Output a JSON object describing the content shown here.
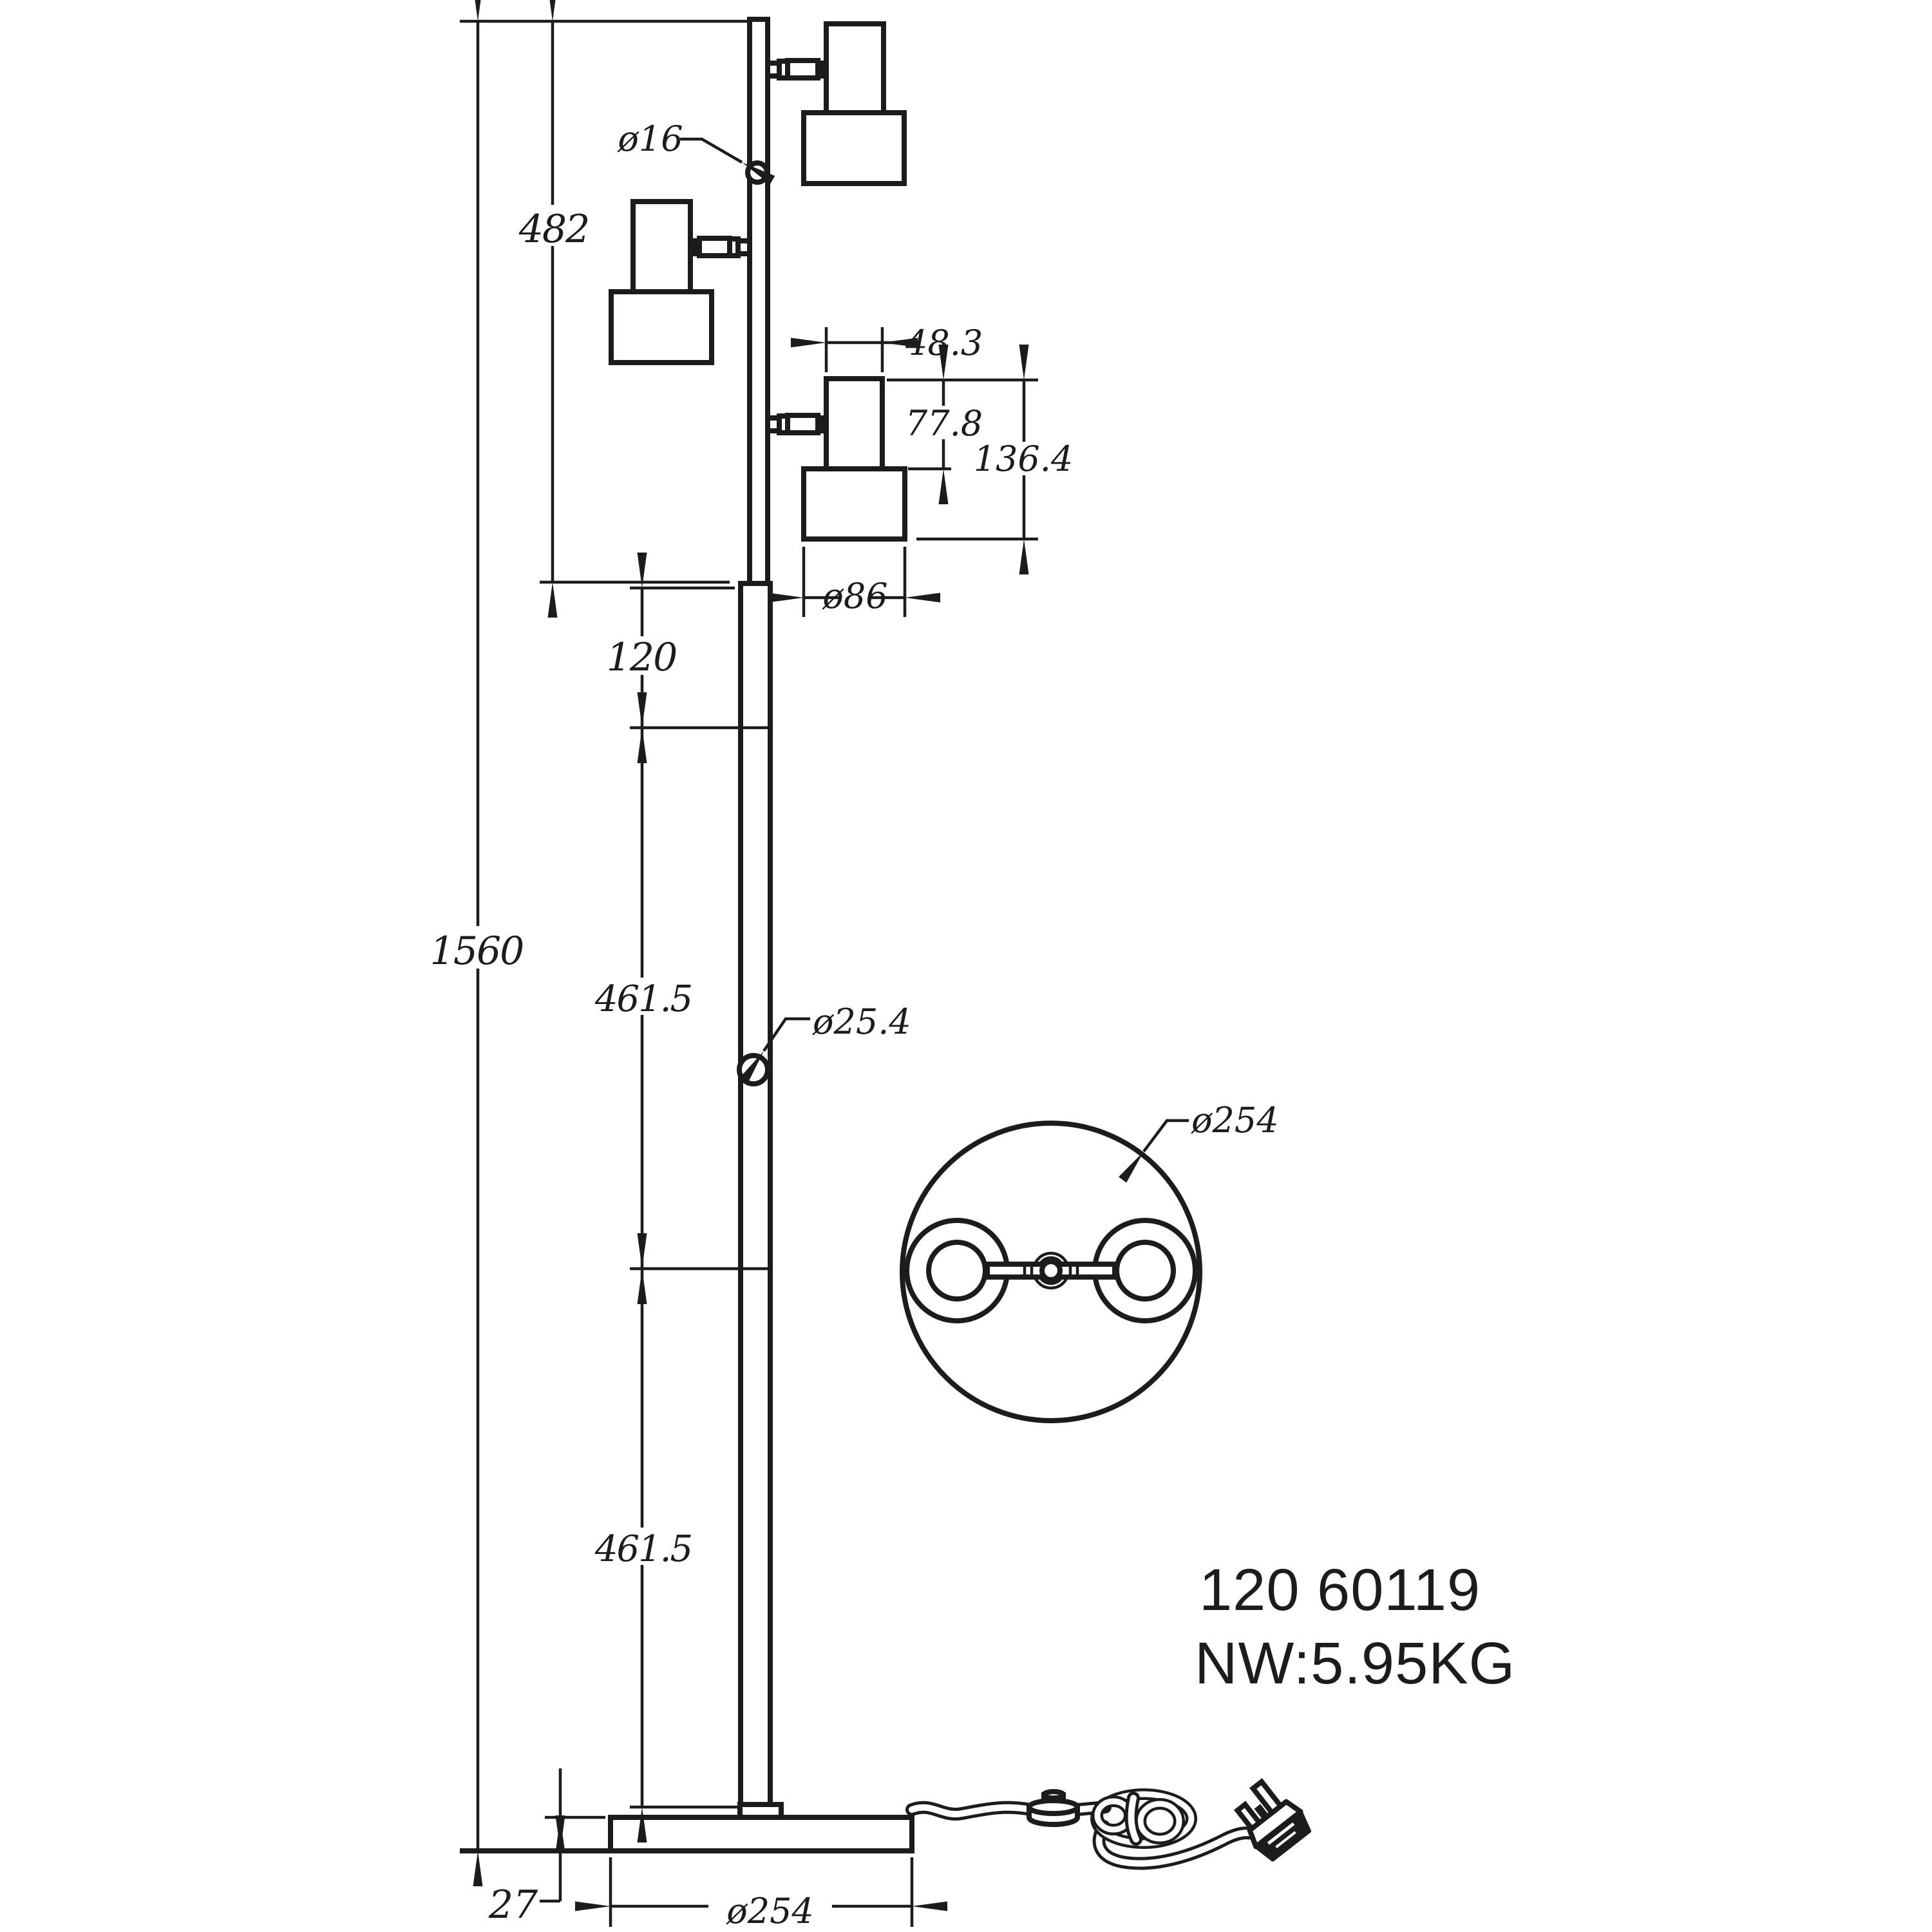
{
  "front_view": {
    "overall_height": "1560",
    "upper_section_height": "482",
    "upper_pole_diameter": "ø16",
    "spot_top_width": "48.3",
    "spot_body_height": "77.8",
    "spot_total_height": "136.4",
    "spot_shade_diameter": "ø86",
    "pole_segment_upper": "120",
    "pole_segment_middle": "461.5",
    "pole_segment_lower": "461.5",
    "lower_pole_diameter": "ø25.4",
    "base_thickness": "27",
    "base_diameter": "ø254"
  },
  "top_view": {
    "base_diameter": "ø254"
  },
  "product": {
    "code": "120 60119",
    "net_weight": "NW:5.95KG"
  },
  "colors": {
    "ink": "#1c1c1c",
    "background": "#ffffff"
  }
}
